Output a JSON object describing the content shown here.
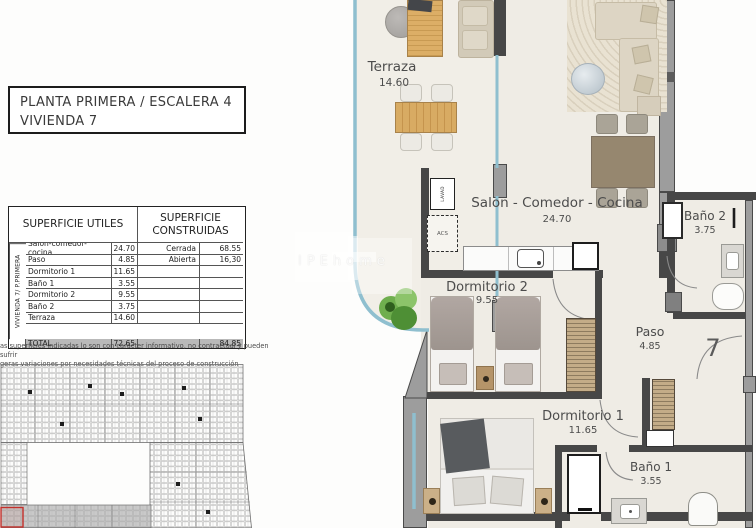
{
  "title_block": {
    "line1": "PLANTA PRIMERA / ESCALERA 4",
    "line2": "VIVIENDA 7"
  },
  "areas_table": {
    "vertical_label": "VIVIENDA 7/ P.PRIMERA",
    "useful_header": "SUPERFICIE UTILES",
    "built_header": "SUPERFICIE CONSTRUIDAS",
    "rows": [
      {
        "name": "Salon-comedor-cocina",
        "value": "24.70",
        "built_name": "Cerrada",
        "built_value": "68.55"
      },
      {
        "name": "Paso",
        "value": "4.85",
        "built_name": "Abierta",
        "built_value": "16,30"
      },
      {
        "name": "Dormitorio 1",
        "value": "11.65",
        "built_name": "",
        "built_value": ""
      },
      {
        "name": "Baño 1",
        "value": "3.55",
        "built_name": "",
        "built_value": ""
      },
      {
        "name": "Dormitorio 2",
        "value": "9.55",
        "built_name": "",
        "built_value": ""
      },
      {
        "name": "Baño 2",
        "value": "3.75",
        "built_name": "",
        "built_value": ""
      },
      {
        "name": "Terraza",
        "value": "14.60",
        "built_name": "",
        "built_value": ""
      }
    ],
    "total_label": "TOTAL",
    "total_useful": "72.65",
    "total_built": "84.85"
  },
  "disclaimer": {
    "line1": "as superficies indicadas lo son con carácter informativo, no contractual y pueden sufrir",
    "line2": "geras variaciones por necesidades técnicas del proceso de construcción"
  },
  "floor_plan": {
    "terraza": {
      "label": "Terraza",
      "area": "14.60"
    },
    "salon": {
      "label": "Salon - Comedor - Cocina",
      "area": "24.70"
    },
    "dormitorio2": {
      "label": "Dormitorio 2",
      "area": "9.55"
    },
    "paso": {
      "label": "Paso",
      "area": "4.85"
    },
    "banyo2": {
      "label": "Baño 2",
      "area": "3.75"
    },
    "dormitorio1": {
      "label": "Dormitorio 1",
      "area": "11.65"
    },
    "banyo1": {
      "label": "Baño 1",
      "area": "3.55"
    },
    "unit_number": "7",
    "utility_labels": {
      "washer": "LAVAD",
      "acs": "ACS"
    }
  },
  "watermark": {
    "text": "IPEhome"
  },
  "colors": {
    "glass": "#8fbfcf",
    "wall_dark": "#474747",
    "wall_gray": "#9d9d9d",
    "floor": "#efece5",
    "wood": "#d3a96b",
    "highlight_red": "#c4302b",
    "total_row_bg": "#b9b9b9"
  }
}
